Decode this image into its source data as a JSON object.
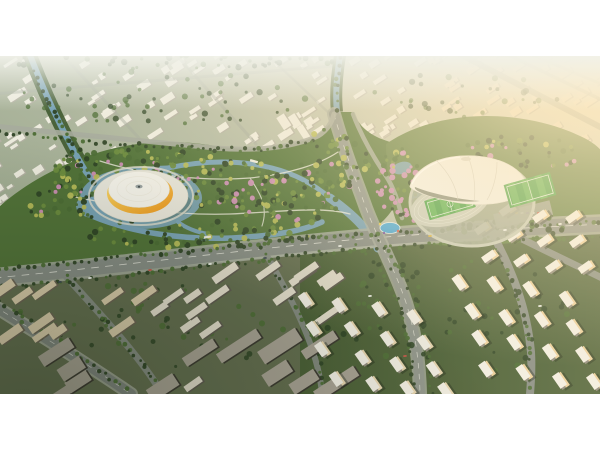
{
  "meta": {
    "type": "architectural-aerial-rendering",
    "description": "Aerial masterplan rendering at golden hour: a central wetland park with winding canals and flowering trees, flanked by a yellow-ring dome arena on the west and a white shell stadium with athletics track and sports fields on the east, surrounded by city blocks, arterial roads and residential towers, letterboxed with white bars",
    "canvas": {
      "width": 600,
      "height": 450
    },
    "frame": {
      "top": 56,
      "height": 338,
      "background": "#ffffff"
    }
  },
  "palette": {
    "base_left": "#97a589",
    "base_mid": "#b4bba4",
    "base_right": "#e9e3cd",
    "city_roof": "#f0ede1",
    "city_shade": "#b5b2a4",
    "city_warm": "#ece0c6",
    "green_dark": "#2f4526",
    "green_mid": "#4c6d35",
    "green_light": "#6d8c3e",
    "green_yellow": "#b7bc58",
    "blossom": "#cf8fb6",
    "park_fill": "#527339",
    "stadium_ground": "#5d7c41",
    "water": "#78a2b5",
    "water_light": "#9fc3cb",
    "pool_blue": "#49a8d8",
    "road": "#878d85",
    "road_light": "#a6ab9d",
    "road_dark": "#7f857e",
    "lane": "#e9e9df",
    "plaza": "#e9e7dc",
    "dome_white": "#f6f4ec",
    "dome_rib": "#dcd8ca",
    "dome_yellow1": "#fadf70",
    "dome_yellow2": "#ee9416",
    "shell_white": "#f3f1e8",
    "shell_shade": "#cfccbe",
    "shell_dark": "#6d7562",
    "track": "#c9cdbd",
    "field": "#46a046",
    "field_stripe": "#5ab152",
    "field_line": "#e8f2e4",
    "rowhouse_roof": "#e3ddcc",
    "rowhouse_side": "#5f5a50",
    "beige_roof": "#d9cbaa",
    "beige_side": "#6b6353",
    "dark_slab_roof": "#a8a294",
    "dark_slab_side": "#3a372f",
    "tower_roof": "#f3f0e6",
    "tower_lit": "#e8d6b0",
    "amber_lit": "#ecd09c",
    "tower_shade": "#8e897c",
    "ground_bl": "#5b6547",
    "ground_br": "#43592f",
    "sun": "#ffe9bd",
    "haze": "#f1f2ea",
    "shadow": "#16200f"
  },
  "scene": {
    "landmarks": {
      "left_arena": "Dome arena with amber glass ring on a white island plaza",
      "right_stadium": "White shell stadium with athletics track and soccer fields",
      "park": "Central wetland park with canals, paths and flowering trees"
    },
    "mixes": {
      "park": [
        [
          "green_dark",
          26
        ],
        [
          "green_mid",
          28
        ],
        [
          "green_light",
          20
        ],
        [
          "green_yellow",
          16
        ],
        [
          "blossom",
          10
        ]
      ],
      "south": [
        [
          "green_dark",
          40
        ],
        [
          "green_mid",
          25
        ],
        [
          "green_yellow",
          20
        ],
        [
          "green_light",
          15
        ]
      ],
      "pink": [
        [
          "blossom",
          45
        ],
        [
          "green_mid",
          20
        ],
        [
          "green_light",
          15
        ],
        [
          "green_yellow",
          10
        ],
        [
          "green_dark",
          10
        ]
      ],
      "city": [
        [
          "green_mid",
          55
        ],
        [
          "green_dark",
          45
        ]
      ],
      "dark": [
        [
          "green_dark",
          60
        ],
        [
          "green_mid",
          40
        ]
      ],
      "roadside": [
        [
          "green_dark",
          55
        ],
        [
          "green_mid",
          45
        ]
      ]
    },
    "city_clusters": [
      {
        "x": -15,
        "y": -8,
        "w": 345,
        "h": 126,
        "count": 95,
        "rot": -33,
        "wmin": 5,
        "wmax": 16,
        "hmin": 3,
        "hmax": 7,
        "roof": "city_roof",
        "shade": "city_shade"
      },
      {
        "x": -10,
        "y": 100,
        "w": 95,
        "h": 108,
        "count": 26,
        "rot": -33,
        "wmin": 5,
        "wmax": 14,
        "hmin": 3,
        "hmax": 7,
        "roof": "city_roof",
        "shade": "city_shade"
      },
      {
        "x": 282,
        "y": 58,
        "w": 54,
        "h": 96,
        "count": 10,
        "rot": -33,
        "wmin": 6,
        "wmax": 9,
        "hmin": 12,
        "hmax": 19,
        "roof": "city_roof",
        "shade": "city_shade"
      },
      {
        "x": 352,
        "y": -6,
        "w": 92,
        "h": 86,
        "count": 24,
        "rot": -33,
        "wmin": 5,
        "wmax": 14,
        "hmin": 3,
        "hmax": 7,
        "roof": "city_roof",
        "shade": "city_shade"
      },
      {
        "x": 430,
        "y": -8,
        "w": 175,
        "h": 94,
        "count": 52,
        "rot": -33,
        "wmin": 5,
        "wmax": 15,
        "hmin": 3,
        "hmax": 7,
        "roof": "city_warm",
        "shade": "city_shade"
      },
      {
        "x": 540,
        "y": 74,
        "w": 64,
        "h": 50,
        "count": 12,
        "rot": -33,
        "wmin": 8,
        "wmax": 17,
        "hmin": 4,
        "hmax": 7,
        "roof": "city_warm",
        "shade": "city_shade"
      }
    ],
    "tree_blobs": [
      {
        "cx": 110,
        "cy": 116,
        "rx": 62,
        "ry": 26,
        "count": 85,
        "mix": "park"
      },
      {
        "cx": 205,
        "cy": 122,
        "rx": 72,
        "ry": 28,
        "count": 100,
        "mix": "park"
      },
      {
        "cx": 285,
        "cy": 142,
        "rx": 55,
        "ry": 28,
        "count": 80,
        "mix": "park"
      },
      {
        "cx": 195,
        "cy": 178,
        "rx": 115,
        "ry": 15,
        "count": 70,
        "mix": "south"
      },
      {
        "cx": 335,
        "cy": 103,
        "rx": 36,
        "ry": 32,
        "count": 55,
        "mix": "park"
      },
      {
        "cx": 398,
        "cy": 126,
        "rx": 24,
        "ry": 36,
        "count": 46,
        "mix": "pink"
      },
      {
        "cx": 68,
        "cy": 148,
        "rx": 40,
        "ry": 20,
        "count": 40,
        "mix": "park"
      },
      {
        "cx": 520,
        "cy": 96,
        "rx": 62,
        "ry": 20,
        "count": 42,
        "mix": "park"
      },
      {
        "cx": 432,
        "cy": 152,
        "rx": 36,
        "ry": 15,
        "count": 30,
        "mix": "pink"
      },
      {
        "cx": 508,
        "cy": 170,
        "rx": 64,
        "ry": 12,
        "count": 32,
        "mix": "dark"
      },
      {
        "cx": 160,
        "cy": 42,
        "rx": 150,
        "ry": 28,
        "count": 55,
        "mix": "city",
        "op": 0.75
      },
      {
        "cx": 470,
        "cy": 40,
        "rx": 100,
        "ry": 24,
        "count": 30,
        "mix": "city",
        "op": 0.7
      },
      {
        "cx": 170,
        "cy": 6,
        "rx": 180,
        "ry": 7,
        "count": 40,
        "mix": "city",
        "op": 0.8
      },
      {
        "cx": 450,
        "cy": 262,
        "rx": 130,
        "ry": 58,
        "count": 65,
        "mix": "dark",
        "op": 0.9
      },
      {
        "cx": 150,
        "cy": 272,
        "rx": 140,
        "ry": 48,
        "count": 50,
        "mix": "dark",
        "op": 0.85
      }
    ],
    "tree_lines": [
      {
        "pts": [
          [
            0,
            213
          ],
          [
            160,
            198
          ],
          [
            320,
            181
          ],
          [
            470,
            172
          ],
          [
            600,
            166
          ]
        ],
        "mix": "roadside"
      },
      {
        "pts": [
          [
            0,
            231
          ],
          [
            160,
            216
          ],
          [
            320,
            197
          ],
          [
            470,
            186
          ],
          [
            600,
            180
          ]
        ],
        "mix": "roadside"
      },
      {
        "pts": [
          [
            352,
            182
          ],
          [
            378,
            210
          ],
          [
            398,
            244
          ],
          [
            410,
            290
          ],
          [
            414,
            334
          ]
        ],
        "mix": "roadside"
      },
      {
        "pts": [
          [
            374,
            180
          ],
          [
            400,
            212
          ],
          [
            418,
            250
          ],
          [
            428,
            300
          ],
          [
            432,
            336
          ]
        ],
        "mix": "roadside"
      },
      {
        "pts": [
          [
            0,
            244
          ],
          [
            60,
            286
          ],
          [
            126,
            334
          ]
        ],
        "mix": "roadside"
      },
      {
        "pts": [
          [
            66,
            220
          ],
          [
            102,
            262
          ],
          [
            144,
            310
          ],
          [
            162,
            336
          ]
        ],
        "mix": "roadside"
      },
      {
        "pts": [
          [
            26,
            2
          ],
          [
            50,
            48
          ],
          [
            74,
            96
          ],
          [
            90,
            122
          ]
        ],
        "mix": "dark"
      },
      {
        "pts": [
          [
            340,
            2
          ],
          [
            336,
            30
          ],
          [
            338,
            54
          ]
        ],
        "mix": "dark"
      },
      {
        "pts": [
          [
            262,
            193
          ],
          [
            296,
            250
          ],
          [
            320,
            300
          ],
          [
            322,
            336
          ]
        ],
        "mix": "roadside"
      },
      {
        "pts": [
          [
            490,
            180
          ],
          [
            512,
            226
          ],
          [
            528,
            278
          ],
          [
            530,
            332
          ]
        ],
        "mix": "roadside"
      },
      {
        "pts": [
          [
            0,
            76
          ],
          [
            90,
            86
          ],
          [
            190,
            92
          ],
          [
            260,
            94
          ],
          [
            312,
            84
          ]
        ],
        "mix": "dark"
      }
    ],
    "row_clusters": [
      {
        "name": "terrace-block",
        "x": 215,
        "y": 212,
        "w": 118,
        "h": 60,
        "count": 9,
        "rot": -35,
        "lmin": 20,
        "lmax": 30,
        "dmin": 6,
        "dmax": 8,
        "roof": "rowhouse_roof",
        "side": "rowhouse_side"
      },
      {
        "name": "terrace-block",
        "x": 150,
        "y": 240,
        "w": 68,
        "h": 92,
        "count": 7,
        "rot": -35,
        "lmin": 16,
        "lmax": 24,
        "dmin": 5,
        "dmax": 7,
        "roof": "rowhouse_roof",
        "side": "rowhouse_side"
      },
      {
        "name": "midrise-block",
        "x": 0,
        "y": 222,
        "w": 150,
        "h": 58,
        "count": 10,
        "rot": -35,
        "lmin": 16,
        "lmax": 28,
        "dmin": 6,
        "dmax": 9,
        "roof": "beige_roof",
        "side": "beige_side"
      },
      {
        "name": "slab-block",
        "x": 110,
        "y": 286,
        "w": 250,
        "h": 50,
        "count": 8,
        "rot": -33,
        "lmin": 28,
        "lmax": 56,
        "dmin": 10,
        "dmax": 15,
        "roof": "dark_slab_roof",
        "side": "dark_slab_side"
      },
      {
        "name": "slab-block",
        "x": 0,
        "y": 280,
        "w": 100,
        "h": 56,
        "count": 4,
        "rot": -33,
        "lmin": 24,
        "lmax": 44,
        "dmin": 9,
        "dmax": 14,
        "roof": "dark_slab_roof",
        "side": "dark_slab_side"
      }
    ],
    "tower_clusters": [
      {
        "name": "white-tower",
        "x": 306,
        "y": 246,
        "rows": 4,
        "cols": 4,
        "dx": 37,
        "dy": 25,
        "sx": 10,
        "sy": 5,
        "w": 9,
        "h": 15,
        "rot": -35,
        "roof": "tower_roof",
        "lit": "tower_lit",
        "shade": "tower_shade"
      },
      {
        "name": "amber-tower",
        "x": 462,
        "y": 226,
        "rows": 4,
        "cols": 4,
        "dx": 35,
        "dy": 29,
        "sx": 9,
        "sy": 5,
        "w": 9,
        "h": 16,
        "rot": -35,
        "roof": "tower_roof",
        "lit": "amber_lit",
        "shade": "tower_shade"
      },
      {
        "name": "amber-slab",
        "x": 474,
        "y": 150,
        "rows": 3,
        "cols": 4,
        "dx": 33,
        "dy": 25,
        "sx": 7,
        "sy": 4,
        "w": 15,
        "h": 8,
        "rot": -35,
        "roof": "tower_roof",
        "lit": "amber_lit",
        "shade": "tower_shade"
      }
    ],
    "cars": [
      [
        90,
        222,
        "#eef0ea"
      ],
      [
        150,
        214,
        "#c45548"
      ],
      [
        210,
        208,
        "#eef0ea"
      ],
      [
        265,
        202,
        "#3f4a52"
      ],
      [
        340,
        190,
        "#eef0ea"
      ],
      [
        430,
        180,
        "#d9b13f"
      ],
      [
        505,
        174,
        "#eef0ea"
      ],
      [
        370,
        240,
        "#eef0ea"
      ],
      [
        405,
        300,
        "#c45548"
      ],
      [
        540,
        250,
        "#eef0ea"
      ],
      [
        60,
        226,
        "#3f4a52"
      ],
      [
        560,
        168,
        "#eef0ea"
      ]
    ],
    "parking_cars": {
      "x": 500,
      "y": 157,
      "dx": 5.5,
      "colors": [
        "#d95f4e",
        "#eef0ea",
        "#4a6fa5",
        "#e0b84a",
        "#eef0ea",
        "#7a4fa0",
        "#eef0ea",
        "#c45548",
        "#9fb0b8"
      ]
    }
  }
}
